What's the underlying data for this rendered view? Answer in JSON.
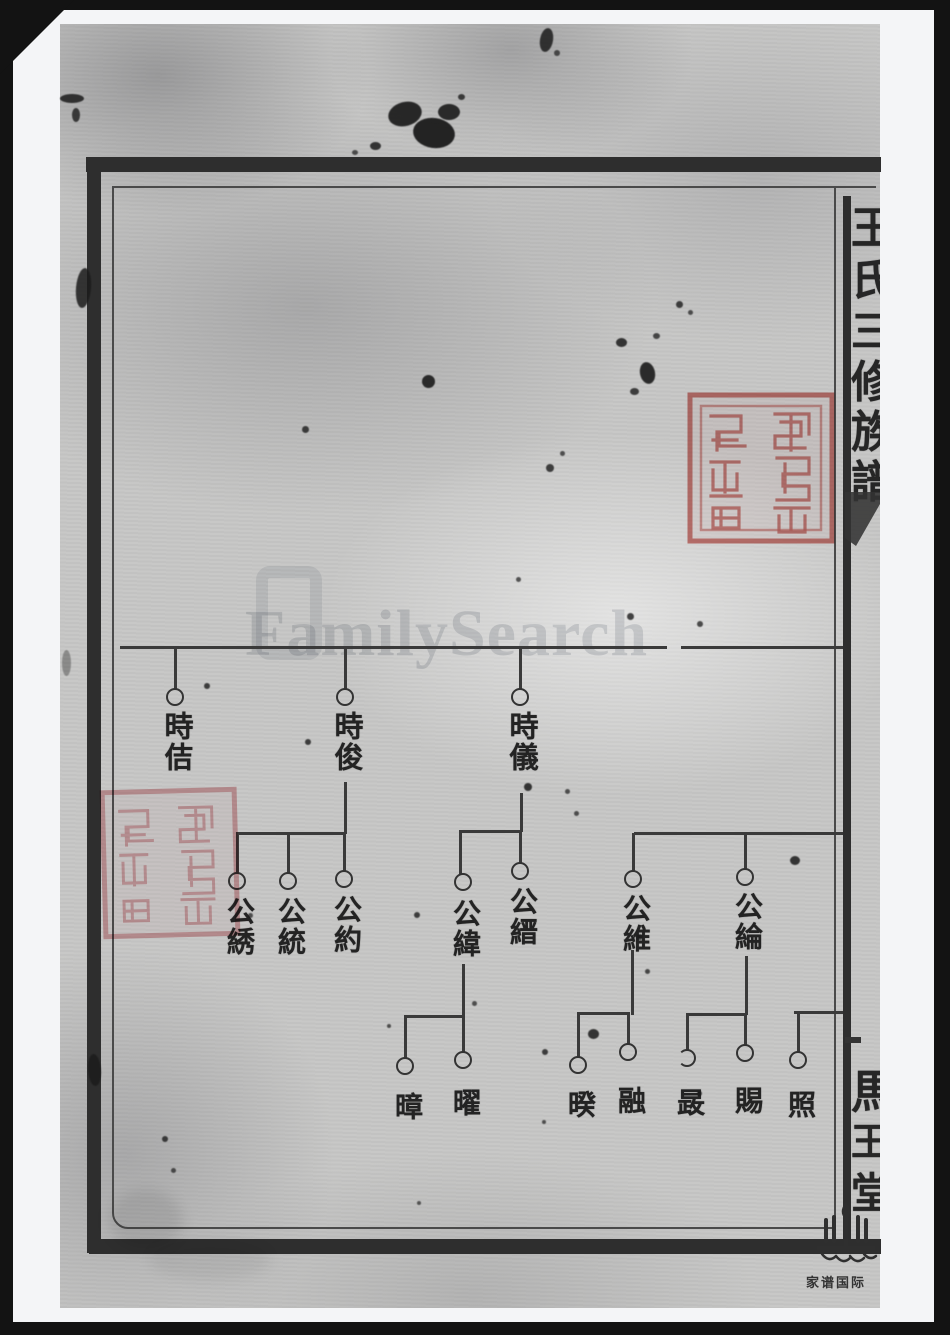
{
  "page": {
    "watermark": "FamilySearch",
    "spine": {
      "title_chars": [
        "王",
        "氏",
        "三",
        "修",
        "族",
        "譜"
      ],
      "hall_chars": [
        "馬",
        "王",
        "堂"
      ],
      "publisher_footer": "家谱国际"
    },
    "tree": {
      "generation1": [
        {
          "name": "時佶"
        },
        {
          "name": "時俊"
        },
        {
          "name": "時儀"
        }
      ],
      "generation2": [
        {
          "name": "公綉"
        },
        {
          "name": "公統"
        },
        {
          "name": "公約"
        },
        {
          "name": "公緯"
        },
        {
          "name": "公縉"
        },
        {
          "name": "公維"
        },
        {
          "name": "公綸"
        }
      ],
      "generation3": [
        {
          "name": "暲"
        },
        {
          "name": "曜"
        },
        {
          "name": "暌"
        },
        {
          "name": "融"
        },
        {
          "name": "晸"
        },
        {
          "name": "賜"
        },
        {
          "name": "照"
        }
      ]
    },
    "colors": {
      "seal_red": "#cf6b66",
      "seal_red_light": "#df9da2",
      "paper_gray": "#c7c7c6",
      "frame_dark": "#2e2e2e",
      "matte_white": "#f4f5f7"
    }
  }
}
